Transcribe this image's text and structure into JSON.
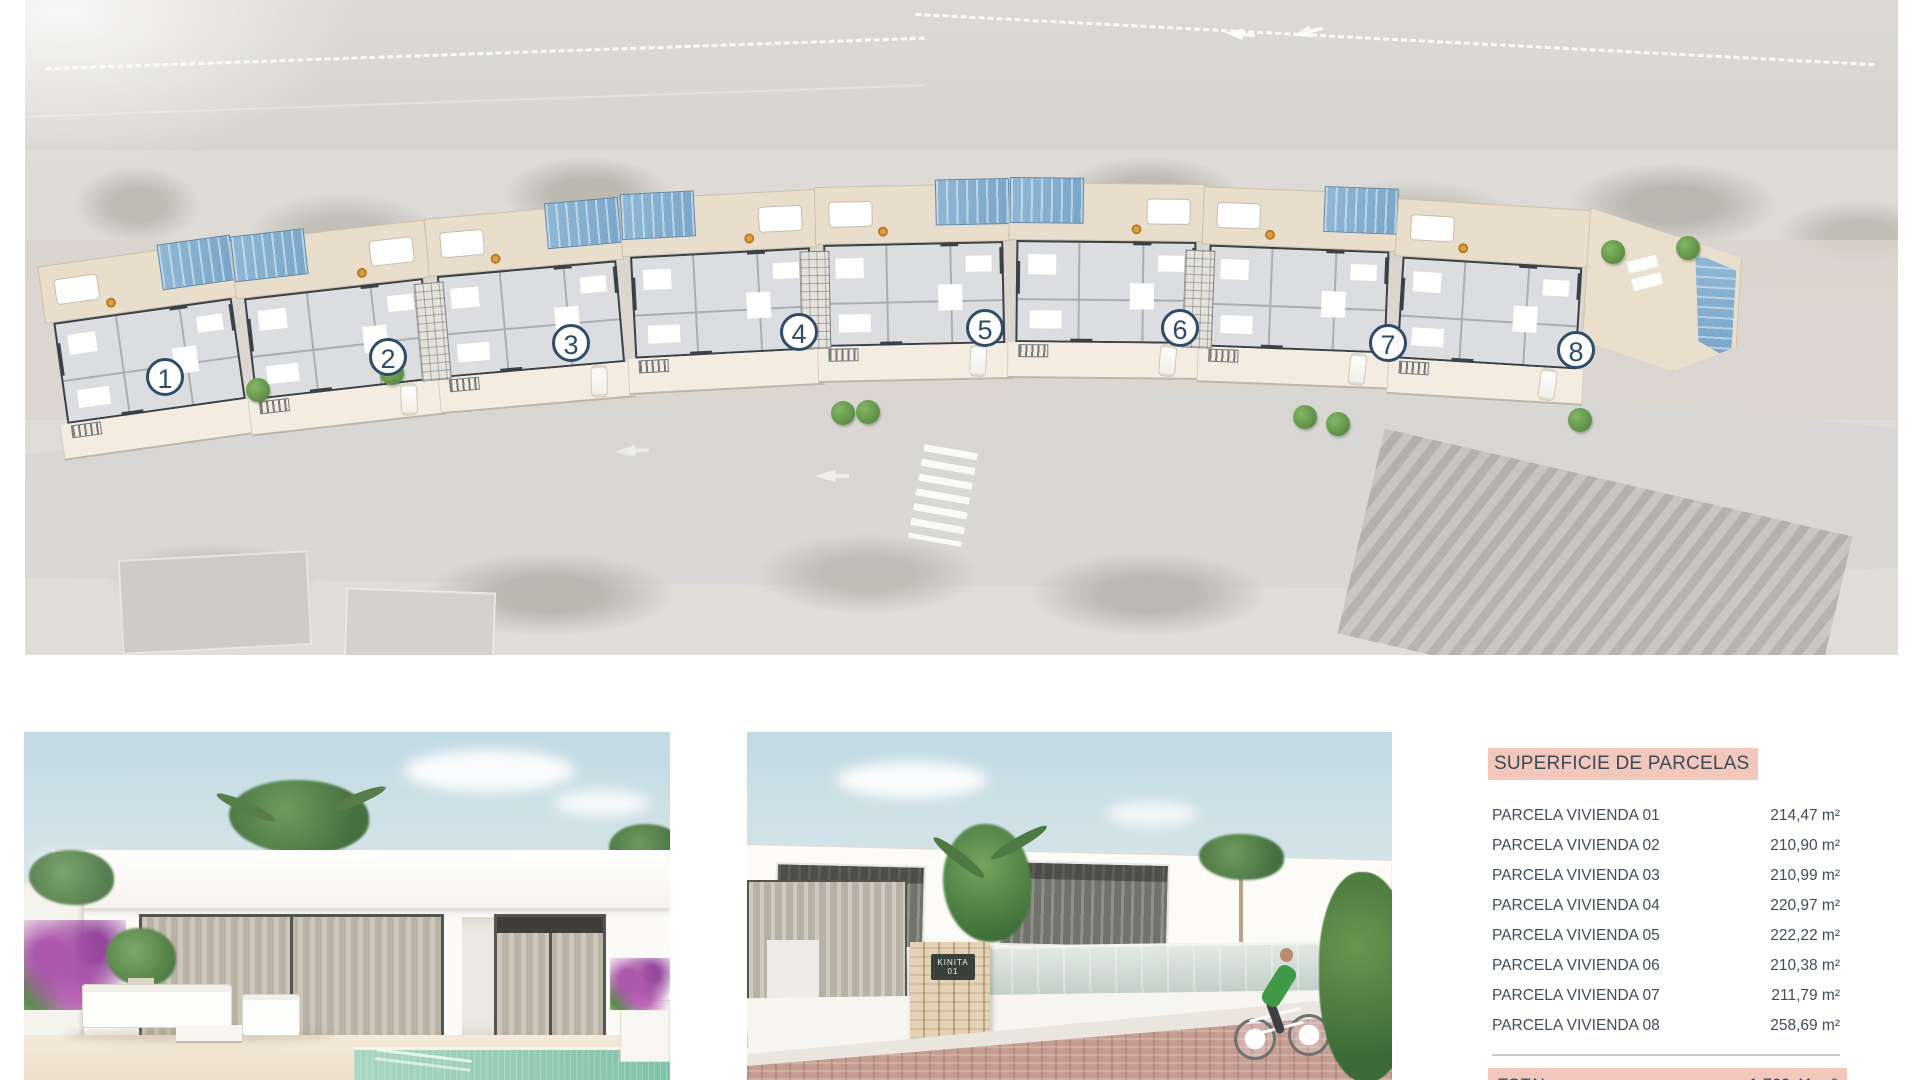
{
  "table": {
    "title": "SUPERFICIE DE PARCELAS",
    "rows": [
      {
        "label": "PARCELA VIVIENDA 01",
        "value": "214,47 m²"
      },
      {
        "label": "PARCELA VIVIENDA 02",
        "value": "210,90 m²"
      },
      {
        "label": "PARCELA VIVIENDA 03",
        "value": "210,99 m²"
      },
      {
        "label": "PARCELA VIVIENDA 04",
        "value": "220,97 m²"
      },
      {
        "label": "PARCELA VIVIENDA 05",
        "value": "222,22 m²"
      },
      {
        "label": "PARCELA VIVIENDA 06",
        "value": "210,38 m²"
      },
      {
        "label": "PARCELA VIVIENDA 07",
        "value": "211,79 m²"
      },
      {
        "label": "PARCELA VIVIENDA 08",
        "value": "258,69 m²"
      }
    ],
    "total": {
      "label": "TOTAL",
      "value": "1.760,41 m²"
    },
    "colors": {
      "accent": "#f2c8bc",
      "text": "#414c59",
      "rule": "#cfc9c3"
    }
  },
  "site_plan": {
    "houses": [
      {
        "number": "1",
        "x": 52,
        "y": 252,
        "rot": -8,
        "pool": "right",
        "car": false,
        "hatch": false,
        "cx": 165,
        "cy": 377
      },
      {
        "number": "2",
        "x": 242,
        "y": 230,
        "rot": -6.5,
        "pool": "left",
        "car": true,
        "hatch": false,
        "cx": 388,
        "cy": 357
      },
      {
        "number": "3",
        "x": 434,
        "y": 210,
        "rot": -5,
        "pool": "right",
        "car": true,
        "hatch": true,
        "cx": 571,
        "cy": 343
      },
      {
        "number": "4",
        "x": 626,
        "y": 194,
        "rot": -3,
        "pool": "left",
        "car": false,
        "hatch": false,
        "cx": 799,
        "cy": 332
      },
      {
        "number": "5",
        "x": 818,
        "y": 185,
        "rot": -1.2,
        "pool": "right",
        "car": true,
        "hatch": true,
        "cx": 985,
        "cy": 328
      },
      {
        "number": "6",
        "x": 1010,
        "y": 183,
        "rot": 0.6,
        "pool": "left",
        "car": true,
        "hatch": false,
        "cx": 1180,
        "cy": 328
      },
      {
        "number": "7",
        "x": 1202,
        "y": 190,
        "rot": 2.2,
        "pool": "right",
        "car": true,
        "hatch": true,
        "cx": 1388,
        "cy": 343
      },
      {
        "number": "8",
        "x": 1394,
        "y": 204,
        "rot": 3.5,
        "pool": "none",
        "car": true,
        "hatch": false,
        "cx": 1576,
        "cy": 350,
        "end": true
      }
    ],
    "trees": [
      [
        258,
        390
      ],
      [
        392,
        373
      ],
      [
        843,
        413
      ],
      [
        868,
        412
      ],
      [
        1305,
        417
      ],
      [
        1338,
        424
      ],
      [
        1580,
        420
      ],
      [
        1613,
        252
      ],
      [
        1688,
        248
      ]
    ],
    "colors": {
      "terrace": "#e9decb",
      "pool": "#7aa5c8",
      "plan_fill": "#dcdde0",
      "wall": "#3c4147",
      "driveway": "#f4ece1",
      "number_circle": "#2e4c68",
      "tree": "#4e7c3a"
    }
  },
  "renders": [
    {
      "alt": "villa exterior render with terrace, outdoor sofa and pool"
    },
    {
      "alt": "villa entrance render with stone pillar sign and cyclist",
      "sign": {
        "line1": "KINITA",
        "line2": "01"
      }
    }
  ]
}
